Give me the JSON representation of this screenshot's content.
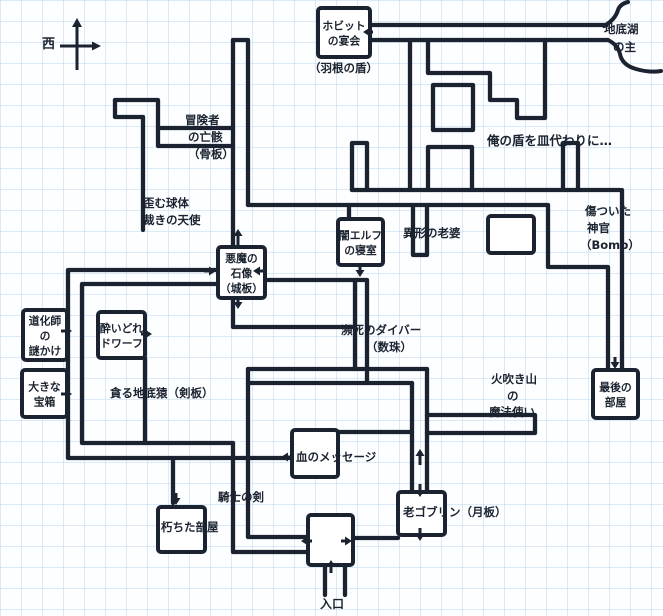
{
  "map": {
    "width": 663,
    "height": 616,
    "colors": {
      "paper": "#fdfeff",
      "grid": "#b9d5ec",
      "ink": "#1b2330"
    },
    "grid_cell": 21,
    "compass": {
      "west_label": "西",
      "cx": 77,
      "cy": 46
    },
    "rooms": [
      {
        "name": "hobbit-banquet-room",
        "x": 318,
        "y": 8,
        "w": 52,
        "h": 49,
        "lines": [
          "ホビット",
          "の宴会"
        ]
      },
      {
        "name": "demon-statue-room",
        "x": 218,
        "y": 247,
        "w": 47,
        "h": 51,
        "lines": [
          "悪魔の",
          "石像",
          "（城板）"
        ]
      },
      {
        "name": "dark-elf-bedroom",
        "x": 338,
        "y": 219,
        "w": 45,
        "h": 46,
        "lines": [
          "闇エルフ",
          "の寝室"
        ]
      },
      {
        "name": "jester-riddle-room",
        "x": 23,
        "y": 310,
        "w": 44,
        "h": 50,
        "lines": [
          "道化師",
          "の",
          "謎かけ"
        ]
      },
      {
        "name": "big-chest-room",
        "x": 22,
        "y": 370,
        "w": 45,
        "h": 47,
        "lines": [
          "大きな",
          "宝箱"
        ]
      },
      {
        "name": "drunken-dwarf-room",
        "x": 98,
        "y": 312,
        "w": 47,
        "h": 46,
        "lines": [
          "酔いどれ",
          "ドワーフ"
        ]
      },
      {
        "name": "blood-message-room",
        "x": 292,
        "y": 430,
        "w": 46,
        "h": 47,
        "lines": []
      },
      {
        "name": "rotted-room",
        "x": 158,
        "y": 507,
        "w": 47,
        "h": 45,
        "lines": []
      },
      {
        "name": "old-goblin-room",
        "x": 398,
        "y": 492,
        "w": 47,
        "h": 43,
        "lines": []
      },
      {
        "name": "entrance-room",
        "x": 308,
        "y": 515,
        "w": 45,
        "h": 50,
        "lines": []
      },
      {
        "name": "last-room",
        "x": 593,
        "y": 370,
        "w": 45,
        "h": 48,
        "lines": [
          "最後の",
          "部屋"
        ]
      },
      {
        "name": "unlabeled-room",
        "x": 488,
        "y": 216,
        "w": 46,
        "h": 37,
        "lines": []
      }
    ],
    "labels": [
      {
        "text": "（羽根の盾）",
        "x": 309,
        "y": 72
      },
      {
        "text": "地底湖",
        "x": 604,
        "y": 33
      },
      {
        "text": "の主",
        "x": 613,
        "y": 51
      },
      {
        "text": "冒険者",
        "x": 185,
        "y": 124
      },
      {
        "text": "の亡骸",
        "x": 188,
        "y": 141
      },
      {
        "text": "（骨板）",
        "x": 188,
        "y": 158
      },
      {
        "text": "俺の盾を皿代わりに…",
        "x": 487,
        "y": 145,
        "size": 12.5
      },
      {
        "text": "歪む球体",
        "x": 143,
        "y": 207
      },
      {
        "text": "裁きの天使",
        "x": 143,
        "y": 224
      },
      {
        "text": "異形の老婆",
        "x": 403,
        "y": 237
      },
      {
        "text": "傷ついた",
        "x": 585,
        "y": 215
      },
      {
        "text": "神官",
        "x": 587,
        "y": 232
      },
      {
        "text": "（Bomb）",
        "x": 580,
        "y": 249
      },
      {
        "text": "貪る地底猿（剣板）",
        "x": 110,
        "y": 397
      },
      {
        "text": "瀕死のダイバー",
        "x": 341,
        "y": 334
      },
      {
        "text": "（数珠）",
        "x": 366,
        "y": 351
      },
      {
        "text": "火吹き山",
        "x": 491,
        "y": 383
      },
      {
        "text": "の",
        "x": 507,
        "y": 400
      },
      {
        "text": "魔法使い",
        "x": 489,
        "y": 416
      },
      {
        "text": "血のメッセージ",
        "x": 296,
        "y": 461
      },
      {
        "text": "騎士の剣",
        "x": 218,
        "y": 501
      },
      {
        "text": "朽ちた部屋",
        "x": 161,
        "y": 531
      },
      {
        "text": "老ゴブリン（月板）",
        "x": 403,
        "y": 516
      },
      {
        "text": "入口",
        "x": 320,
        "y": 608,
        "size": 12
      }
    ],
    "corridors": [
      [
        [
          115,
          100
        ],
        [
          158,
          100
        ],
        [
          158,
          128
        ]
      ],
      [
        [
          115,
          100
        ],
        [
          115,
          117
        ],
        [
          143,
          117
        ]
      ],
      [
        [
          143,
          117
        ],
        [
          143,
          230
        ]
      ],
      [
        [
          158,
          128
        ],
        [
          233,
          128
        ]
      ],
      [
        [
          158,
          128
        ],
        [
          158,
          146
        ],
        [
          233,
          146
        ]
      ],
      [
        [
          233,
          40
        ],
        [
          248,
          40
        ]
      ],
      [
        [
          233,
          40
        ],
        [
          233,
          247
        ]
      ],
      [
        [
          248,
          40
        ],
        [
          248,
          205
        ]
      ],
      [
        [
          248,
          205
        ],
        [
          548,
          205
        ]
      ],
      [
        [
          352,
          190
        ],
        [
          620,
          190
        ]
      ],
      [
        [
          352,
          190
        ],
        [
          352,
          143
        ],
        [
          367,
          143
        ],
        [
          367,
          190
        ]
      ],
      [
        [
          370,
          25
        ],
        [
          606,
          25
        ]
      ],
      [
        [
          370,
          40
        ],
        [
          608,
          40
        ]
      ],
      [
        [
          428,
          40
        ],
        [
          428,
          73
        ],
        [
          490,
          73
        ],
        [
          490,
          100
        ],
        [
          517,
          100
        ],
        [
          517,
          118
        ],
        [
          545,
          118
        ],
        [
          545,
          40
        ]
      ],
      [
        [
          433,
          85
        ],
        [
          473,
          85
        ],
        [
          473,
          130
        ],
        [
          433,
          130
        ],
        [
          433,
          85
        ]
      ],
      [
        [
          410,
          40
        ],
        [
          410,
          190
        ]
      ],
      [
        [
          428,
          190
        ],
        [
          428,
          147
        ],
        [
          472,
          147
        ],
        [
          472,
          190
        ]
      ],
      [
        [
          563,
          190
        ],
        [
          563,
          143
        ],
        [
          578,
          143
        ],
        [
          578,
          190
        ]
      ],
      [
        [
          548,
          205
        ],
        [
          548,
          267
        ],
        [
          608,
          267
        ],
        [
          608,
          370
        ]
      ],
      [
        [
          622,
          190
        ],
        [
          622,
          370
        ]
      ],
      [
        [
          413,
          205
        ],
        [
          413,
          255
        ],
        [
          427,
          255
        ],
        [
          427,
          205
        ]
      ],
      [
        [
          349,
          205
        ],
        [
          349,
          219
        ]
      ],
      [
        [
          218,
          270
        ],
        [
          68,
          270
        ],
        [
          68,
          458
        ],
        [
          292,
          458
        ]
      ],
      [
        [
          218,
          284
        ],
        [
          82,
          284
        ],
        [
          82,
          443
        ],
        [
          233,
          443
        ]
      ],
      [
        [
          145,
          358
        ],
        [
          145,
          443
        ]
      ],
      [
        [
          233,
          298
        ],
        [
          233,
          327
        ],
        [
          352,
          327
        ]
      ],
      [
        [
          233,
          443
        ],
        [
          233,
          552
        ],
        [
          308,
          552
        ]
      ],
      [
        [
          248,
          369
        ],
        [
          248,
          537
        ],
        [
          308,
          537
        ]
      ],
      [
        [
          248,
          369
        ],
        [
          427,
          369
        ]
      ],
      [
        [
          248,
          383
        ],
        [
          412,
          383
        ]
      ],
      [
        [
          355,
          280
        ],
        [
          355,
          369
        ]
      ],
      [
        [
          367,
          280
        ],
        [
          367,
          383
        ]
      ],
      [
        [
          265,
          280
        ],
        [
          367,
          280
        ]
      ],
      [
        [
          412,
          383
        ],
        [
          412,
          492
        ]
      ],
      [
        [
          427,
          369
        ],
        [
          427,
          492
        ]
      ],
      [
        [
          427,
          415
        ],
        [
          535,
          415
        ],
        [
          535,
          433
        ],
        [
          427,
          433
        ]
      ],
      [
        [
          338,
          432
        ],
        [
          412,
          432
        ]
      ],
      [
        [
          353,
          538
        ],
        [
          398,
          538
        ]
      ],
      [
        [
          325,
          565
        ],
        [
          325,
          595
        ]
      ],
      [
        [
          345,
          565
        ],
        [
          345,
          595
        ]
      ],
      [
        [
          173,
          458
        ],
        [
          173,
          503
        ]
      ]
    ],
    "curves": [
      "M604,26 Q615,20 618,10 Q620,4 628,2",
      "M608,40 Q618,45 620,54 Q622,65 636,69 Q650,73 661,71"
    ],
    "arrows": [
      {
        "dir": "left",
        "x": 363,
        "y": 32,
        "shaft": 10
      },
      {
        "dir": "up",
        "x": 238,
        "y": 229,
        "shaft": 16
      },
      {
        "dir": "right",
        "x": 216,
        "y": 271,
        "shaft": 12
      },
      {
        "dir": "left",
        "x": 253,
        "y": 271,
        "shaft": 12
      },
      {
        "dir": "down",
        "x": 238,
        "y": 309,
        "shaft": 12
      },
      {
        "dir": "down",
        "x": 360,
        "y": 277,
        "shaft": 12
      },
      {
        "dir": "right",
        "x": 72,
        "y": 331,
        "shaft": 11
      },
      {
        "dir": "right",
        "x": 72,
        "y": 394,
        "shaft": 11
      },
      {
        "dir": "right",
        "x": 152,
        "y": 334,
        "shaft": 11
      },
      {
        "dir": "left",
        "x": 281,
        "y": 457,
        "shaft": 11
      },
      {
        "dir": "up",
        "x": 420,
        "y": 449,
        "shaft": 16
      },
      {
        "dir": "down",
        "x": 420,
        "y": 497,
        "shaft": 13
      },
      {
        "dir": "down",
        "x": 420,
        "y": 541,
        "shaft": 13
      },
      {
        "dir": "down",
        "x": 615,
        "y": 369,
        "shaft": 12
      },
      {
        "dir": "down",
        "x": 176,
        "y": 505,
        "shaft": 12
      },
      {
        "dir": "left",
        "x": 301,
        "y": 541,
        "shaft": 11
      },
      {
        "dir": "right",
        "x": 352,
        "y": 541,
        "shaft": 11
      },
      {
        "dir": "up",
        "x": 331,
        "y": 560,
        "shaft": 13
      }
    ]
  }
}
